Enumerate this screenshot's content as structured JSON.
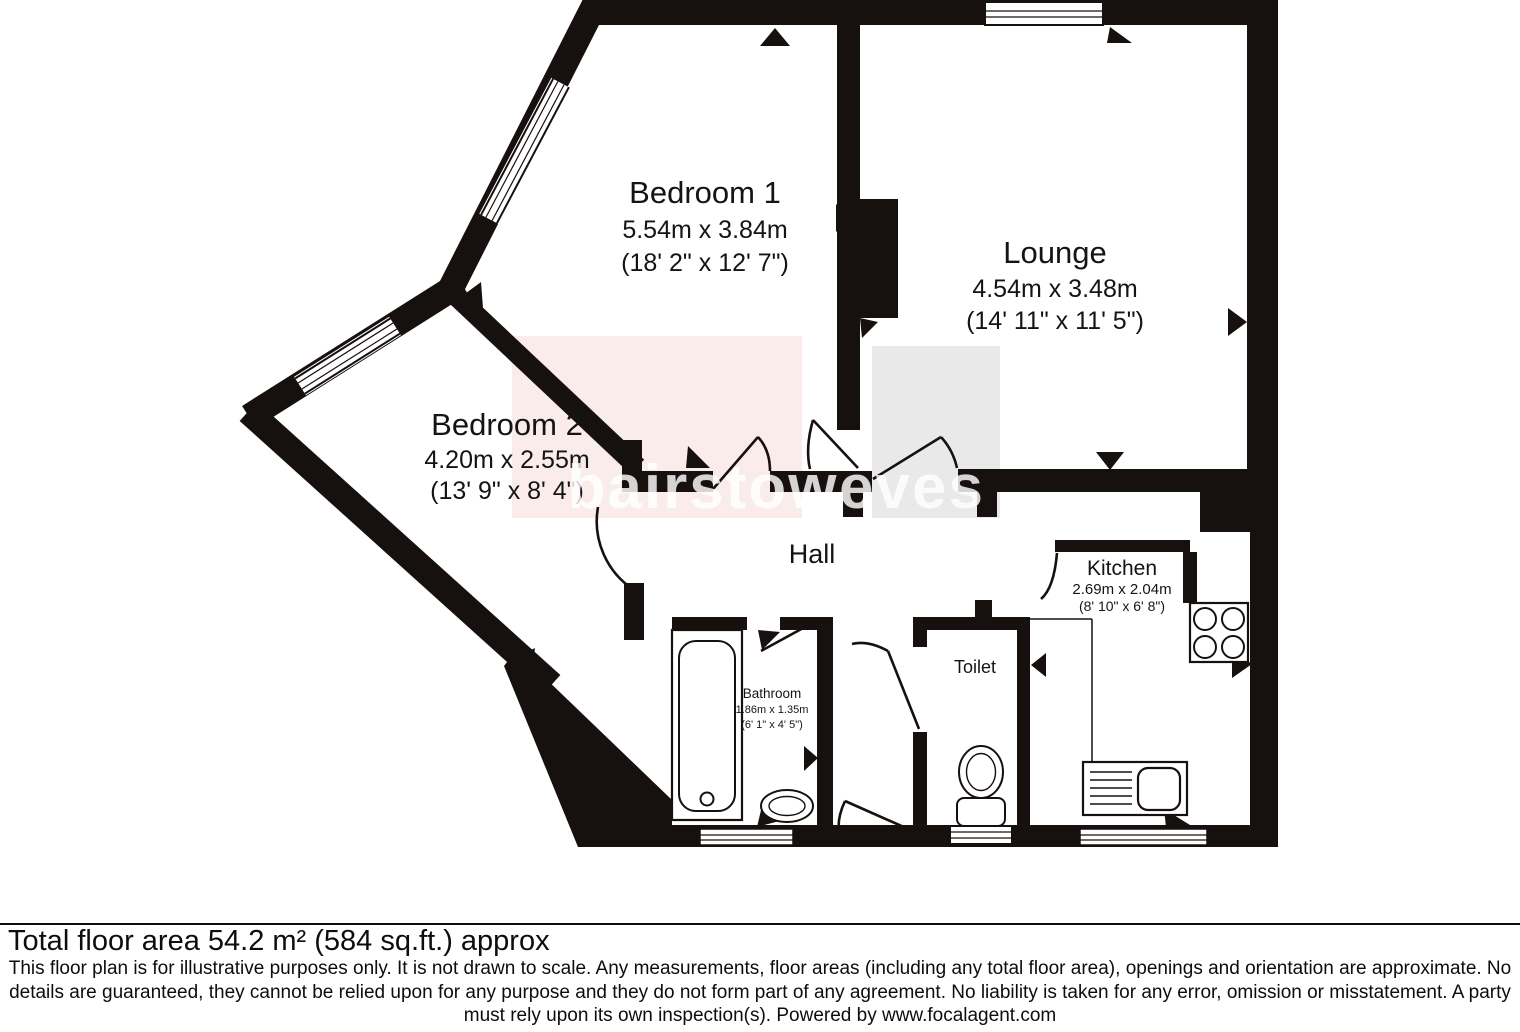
{
  "plan": {
    "wall_color": "#16100f",
    "rooms": [
      {
        "id": "bedroom1",
        "name": "Bedroom 1",
        "metric": "5.54m x 3.84m",
        "imperial": "(18' 2\" x 12' 7\")"
      },
      {
        "id": "bedroom2",
        "name": "Bedroom 2",
        "metric": "4.20m x 2.55m",
        "imperial": "(13' 9\" x 8' 4\")"
      },
      {
        "id": "lounge",
        "name": "Lounge",
        "metric": "4.54m x 3.48m",
        "imperial": "(14' 11\" x 11' 5\")"
      },
      {
        "id": "kitchen",
        "name": "Kitchen",
        "metric": "2.69m x 2.04m",
        "imperial": "(8' 10\" x 6' 8\")"
      },
      {
        "id": "bathroom",
        "name": "Bathroom",
        "metric": "1.86m x 1.35m",
        "imperial": "(6' 1\" x 4' 5\")"
      },
      {
        "id": "toilet",
        "name": "Toilet"
      },
      {
        "id": "hall",
        "name": "Hall"
      }
    ],
    "watermark": {
      "word1": "bairstow",
      "word2": "eves",
      "pink_bg": "#fbecec",
      "gray_bg": "#e9e9e9",
      "text_color": "rgba(255,255,255,0.82)"
    }
  },
  "footer": {
    "total_area": "Total floor area 54.2 m² (584 sq.ft.) approx",
    "disclaimer_lines": [
      "This floor plan is for illustrative purposes only. It is not drawn to scale. Any measurements, floor areas (including any total floor area), openings and orientation are approximate. No",
      "details are guaranteed, they cannot be relied upon for any purpose and they do not form part of any agreement. No liability is taken for any error, omission or misstatement. A party",
      "must rely upon its own inspection(s). Powered by www.focalagent.com"
    ]
  }
}
